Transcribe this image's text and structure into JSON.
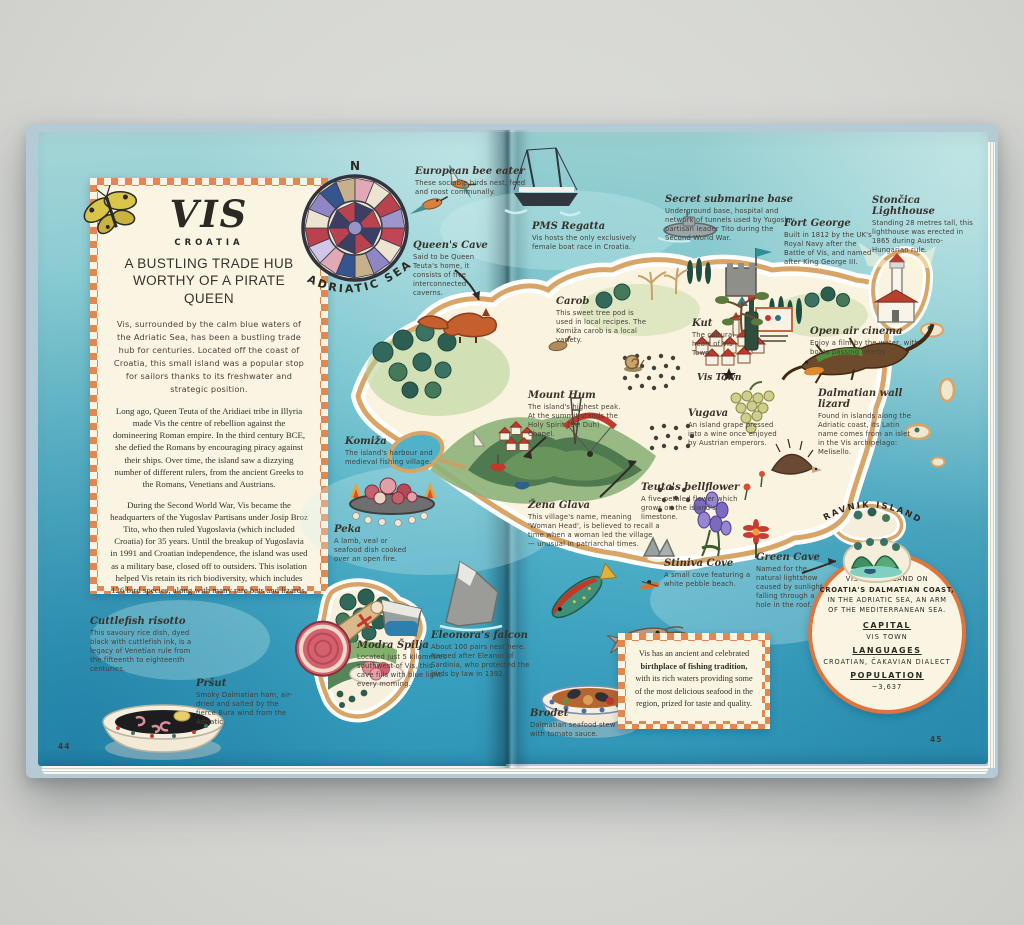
{
  "left_page": {
    "page_number": "44",
    "panel": {
      "title": "VIS",
      "country": "CROATIA",
      "tagline1": "A BUSTLING TRADE HUB",
      "tagline2": "WORTHY OF A PIRATE QUEEN",
      "intro": "Vis, surrounded by the calm blue waters of the Adriatic Sea, has been a bustling trade hub for centuries. Located off the coast of Croatia, this small island was a popular stop for sailors thanks to its freshwater and strategic position.",
      "para2": "Long ago, Queen Teuta of the Aridiaei tribe in Illyria made Vis the centre of rebellion against the domineering Roman empire. In the third century BCE, she defied the Romans by encouraging piracy against their ships. Over time, the island saw a dizzying number of different rulers, from the ancient Greeks to the Romans, Venetians and Austrians.",
      "para3": "During the Second World War, Vis became the headquarters of the Yugoslav Partisans under Josip Broz Tito, who then ruled Yugoslavia (which included Croatia) for 35 years. Until the breakup of Yugoslavia in 1991 and Croatian independence, the island was used as a military base, closed off to outsiders. This isolation helped Vis retain its rich biodiversity, which includes 126 bird species, along with many rare bats and lizards."
    },
    "compass": {
      "north": "N",
      "sea": "ADRIATIC SEA"
    }
  },
  "right_page": {
    "page_number": "45",
    "ravnik_label": "RAVNIK ISLAND",
    "fact_badge": {
      "line1": "VIS IS AN ISLAND ON",
      "line2": "CROATIA'S DALMATIAN COAST,",
      "line3": "IN THE ADRIATIC SEA, AN ARM",
      "line4": "OF THE MEDITERRANEAN SEA.",
      "capital_label": "CAPITAL",
      "capital_value": "VIS TOWN",
      "languages_label": "LANGUAGES",
      "languages_value": "CROATIAN, ČAKAVIAN DIALECT",
      "population_label": "POPULATION",
      "population_value": "~3,637"
    },
    "fishing_note": {
      "text_before": "Vis has an ancient and celebrated ",
      "bold": "birthplace of fishing tradition,",
      "text_after": " with its rich waters providing some of the most delicious seafood in the region, prized for taste and quality."
    }
  },
  "labels": [
    {
      "name": "european-bee-eater",
      "title": "European bee eater",
      "desc": "These sociable birds nest, feed and roost communally."
    },
    {
      "name": "queens-cave",
      "title": "Queen's Cave",
      "desc": "Said to be Queen Teuta's home, it consists of five interconnected caverns."
    },
    {
      "name": "pms-regatta",
      "title": "PMS Regatta",
      "desc": "Vis hosts the only exclusively female boat race in Croatia."
    },
    {
      "name": "secret-submarine-base",
      "title": "Secret submarine base",
      "desc": "Underground base, hospital and network of tunnels used by Yugoslav partisan leader Tito during the Second World War."
    },
    {
      "name": "fort-george",
      "title": "Fort George",
      "desc": "Built in 1812 by the UK's Royal Navy after the Battle of Vis, and named after King George III."
    },
    {
      "name": "stoncica-lighthouse",
      "title": "Stončica Lighthouse",
      "desc": "Standing 28 metres tall, this lighthouse was erected in 1865 during Austro-Hungarian rule."
    },
    {
      "name": "carob",
      "title": "Carob",
      "desc": "This sweet tree pod is used in local recipes. The Komiža carob is a local variety."
    },
    {
      "name": "kut",
      "title": "Kut",
      "desc": "The cultural heart of Vis Town."
    },
    {
      "name": "vis-town",
      "title": "Vis Town",
      "desc": ""
    },
    {
      "name": "open-air-cinema",
      "title": "Open air cinema",
      "desc": "Enjoy a film by the water, with boats passing nearby."
    },
    {
      "name": "dalmatian-wall-lizard",
      "title": "Dalmatian wall lizard",
      "desc": "Found in islands along the Adriatic coast, its Latin name comes from an islet in the Vis archipelago: Melisello."
    },
    {
      "name": "vugava",
      "title": "Vugava",
      "desc": "An island grape pressed into a wine once enjoyed by Austrian emperors."
    },
    {
      "name": "mount-hum",
      "title": "Mount Hum",
      "desc": "The island's highest peak. At the summit stands the Holy Spirit (Sv. Duh) Chapel."
    },
    {
      "name": "komiza",
      "title": "Komiža",
      "desc": "The island's harbour and medieval fishing village."
    },
    {
      "name": "zena-glava",
      "title": "Žena Glava",
      "desc": "This village's name, meaning 'Woman Head', is believed to recall a time when a woman led the village — unusual in patriarchal times."
    },
    {
      "name": "teutas-bellflower",
      "title": "Teuta's bellflower",
      "desc": "A five-petaled flower which grows on the island's limestone."
    },
    {
      "name": "peka",
      "title": "Peka",
      "desc": "A lamb, veal or seafood dish cooked over an open fire."
    },
    {
      "name": "stiniva-cove",
      "title": "Stiniva Cove",
      "desc": "A small cove featuring a white pebble beach."
    },
    {
      "name": "green-cave",
      "title": "Green Cave",
      "desc": "Named for the natural lightshow caused by sunlight falling through a hole in the roof."
    },
    {
      "name": "cuttlefish-risotto",
      "title": "Cuttlefish risotto",
      "desc": "This savoury rice dish, dyed black with cuttlefish ink, is a legacy of Venetian rule from the fifteenth to eighteenth centuries."
    },
    {
      "name": "prsut",
      "title": "Pršut",
      "desc": "Smoky Dalmatian ham, air-dried and salted by the fierce Bura wind from the Adriatic."
    },
    {
      "name": "modra-spilja",
      "title": "Modra Špilja",
      "desc": "Located just 5 kilometres southwest of Vis, this cave fills with blue light every morning."
    },
    {
      "name": "eleonoras-falcon",
      "title": "Eleonora's falcon",
      "desc": "About 100 pairs nest here. Named after Eleanor of Sardinia, who protected the birds by law in 1392."
    },
    {
      "name": "brodet",
      "title": "Brodet",
      "desc": "Dalmatian seafood stew with tomato sauce."
    }
  ]
}
